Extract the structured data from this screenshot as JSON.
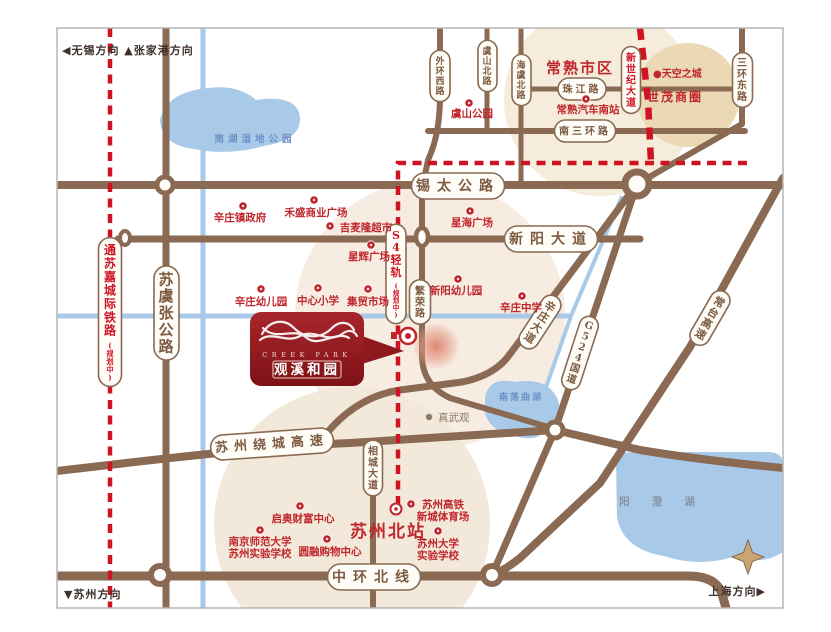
{
  "canvas": {
    "width": 831,
    "height": 632
  },
  "colors": {
    "road_brown": "#8a6a52",
    "road_dark": "#7c5c44",
    "rail_red_dashed": "#cf1322",
    "poi_red": "#c0272d",
    "lake_blue": "#a9c9e9",
    "lake_text_blue": "#6b90c6",
    "beige_zone": "#f3e9da",
    "tan_zone": "#e9d9b4",
    "logo_red": "#9a1e24",
    "frame_gray": "#b5b5b5"
  },
  "directions": [
    {
      "text": "◀无锡方向 ▲张家港方向",
      "x": 62,
      "y": 54,
      "anchor": "start"
    },
    {
      "text": "▼苏州方向",
      "x": 64,
      "y": 598,
      "anchor": "start"
    },
    {
      "text": "上海方向▶",
      "x": 766,
      "y": 595,
      "anchor": "end"
    }
  ],
  "road_pills": [
    {
      "text": "锡太公路",
      "x": 458,
      "y": 186,
      "dir": "h",
      "size": 14,
      "spacing": 7
    },
    {
      "text": "新阳大道",
      "x": 551,
      "y": 239,
      "dir": "h",
      "size": 14,
      "spacing": 7
    },
    {
      "text": "南三环路",
      "x": 585,
      "y": 131,
      "dir": "h",
      "size": 10,
      "spacing": 3
    },
    {
      "text": "珠江路",
      "x": 582,
      "y": 89,
      "dir": "h",
      "size": 10,
      "spacing": 3
    },
    {
      "text": "中环北线",
      "x": 374,
      "y": 577,
      "dir": "h",
      "size": 14,
      "spacing": 7
    },
    {
      "text": "苏州绕城高速",
      "x": 272,
      "y": 444,
      "dir": "h",
      "size": 13,
      "spacing": 6,
      "rotate": -4
    },
    {
      "text": "苏虞张公路",
      "x": 166,
      "y": 313,
      "dir": "v",
      "size": 15
    },
    {
      "text": "外环西路",
      "x": 440,
      "y": 76,
      "dir": "v",
      "size": 9
    },
    {
      "text": "虞山北路",
      "x": 487,
      "y": 66,
      "dir": "v",
      "size": 9
    },
    {
      "text": "海虞北路",
      "x": 521,
      "y": 80,
      "dir": "v",
      "size": 9
    },
    {
      "text": "三环东路",
      "x": 742,
      "y": 80,
      "dir": "v",
      "size": 10
    },
    {
      "text": "新世纪大道",
      "x": 631,
      "y": 80,
      "dir": "v",
      "size": 10,
      "color": "red"
    },
    {
      "text": "S4轻轨",
      "sub": "(规划中)",
      "x": 396,
      "y": 274,
      "dir": "v",
      "size": 11,
      "color": "red"
    },
    {
      "text": "繁荣路",
      "x": 420,
      "y": 302,
      "dir": "v",
      "size": 10
    },
    {
      "text": "相城大道",
      "x": 373,
      "y": 468,
      "dir": "v",
      "size": 10
    },
    {
      "text": "通苏嘉城际铁路",
      "sub": "(规划中)",
      "x": 110,
      "y": 312,
      "dir": "v",
      "size": 12,
      "color": "red"
    },
    {
      "text": "辛庄大道",
      "x": 540,
      "y": 322,
      "dir": "v",
      "size": 11,
      "rotate": 33
    },
    {
      "text": "G524国道",
      "x": 580,
      "y": 353,
      "dir": "v",
      "size": 10,
      "rotate": 18
    },
    {
      "text": "常台高速",
      "x": 710,
      "y": 318,
      "dir": "v",
      "size": 11,
      "rotate": 30
    }
  ],
  "pois": [
    {
      "label": "辛庄镇政府",
      "dot": [
        243,
        206
      ],
      "tx": 240,
      "ty": 221
    },
    {
      "label": "禾盛商业广场",
      "dot": [
        314,
        200
      ],
      "tx": 316,
      "ty": 216
    },
    {
      "label": "吉麦隆超市",
      "dot": [
        330,
        226
      ],
      "tx": 366,
      "ty": 231
    },
    {
      "label": "星辉广场",
      "dot": [
        371,
        245
      ],
      "tx": 369,
      "ty": 260
    },
    {
      "label": "星海广场",
      "dot": [
        470,
        211
      ],
      "tx": 472,
      "ty": 226
    },
    {
      "label": "新阳幼儿园",
      "dot": [
        458,
        279
      ],
      "tx": 456,
      "ty": 294
    },
    {
      "label": "辛庄幼儿园",
      "dot": [
        261,
        289
      ],
      "tx": 261,
      "ty": 305
    },
    {
      "label": "中心小学",
      "dot": [
        318,
        288
      ],
      "tx": 318,
      "ty": 304
    },
    {
      "label": "集贸市场",
      "dot": [
        368,
        289
      ],
      "tx": 368,
      "ty": 305
    },
    {
      "label": "辛庄中学",
      "dot": [
        522,
        296
      ],
      "tx": 521,
      "ty": 311
    },
    {
      "label": "常熟汽车南站",
      "dot": [
        586,
        99
      ],
      "tx": 588,
      "ty": 113
    },
    {
      "label": "虞山公园",
      "dot": [
        469,
        103
      ],
      "tx": 472,
      "ty": 117
    },
    {
      "label": "启奥财富中心",
      "dot": [
        300,
        506
      ],
      "tx": 303,
      "ty": 522
    },
    {
      "label": "南京师范大学\n苏州实验学校",
      "dot": [
        260,
        530
      ],
      "tx": 260,
      "ty": 545
    },
    {
      "label": "圆融购物中心",
      "dot": [
        327,
        539
      ],
      "tx": 330,
      "ty": 555
    },
    {
      "label": "苏州大学\n实验学校",
      "dot": [
        438,
        531
      ],
      "tx": 438,
      "ty": 547
    },
    {
      "label": "苏州高铁\n新城体育场",
      "dot": [
        411,
        504
      ],
      "tx": 443,
      "ty": 508
    }
  ],
  "area_labels": [
    {
      "text": "常熟市区",
      "x": 580,
      "y": 73,
      "size": 15,
      "style": "big"
    },
    {
      "text": "世茂商圈",
      "x": 675,
      "y": 101,
      "size": 12,
      "style": "big"
    },
    {
      "text": "●天空之城",
      "x": 653,
      "y": 77,
      "size": 10,
      "style": "small",
      "anchor": "start"
    },
    {
      "text": "苏州北站",
      "x": 388,
      "y": 537,
      "size": 17,
      "style": "big"
    },
    {
      "text": "真武观",
      "x": 438,
      "y": 421,
      "size": 10,
      "style": "gray",
      "anchor": "start",
      "dot": [
        429,
        417
      ]
    }
  ],
  "lake_labels": [
    {
      "text": "南湖湿地公园",
      "x": 255,
      "y": 142,
      "size": 9.5,
      "spacing": 4,
      "color": "#6b90c6"
    },
    {
      "text": "南荡曲湖",
      "x": 521,
      "y": 400,
      "size": 9,
      "spacing": 2,
      "color": "#6b90c6"
    },
    {
      "text": "阳澄湖",
      "x": 668,
      "y": 505,
      "size": 10.5,
      "spacing": 22,
      "color": "#8a93a0"
    }
  ],
  "logo": {
    "en": "CREEK PARK",
    "cn": "观溪和园"
  }
}
